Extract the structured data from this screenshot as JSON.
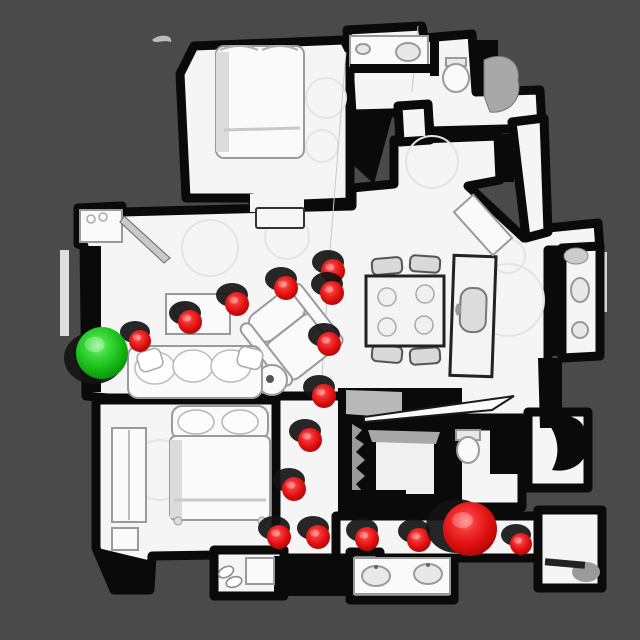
{
  "scene": {
    "description": "Top-down rendered 3D mesh scan of an apartment floor plan with a navigation path shown as spheres",
    "background_color": "#4a4a4a",
    "floor_color": "#f5f5f5",
    "wall_color": "#0a0a0a",
    "view": "top-down"
  },
  "markers": {
    "waypoint_color": "#e01212",
    "start": {
      "label": "start-sphere",
      "color": "#1ec81e",
      "x": 102,
      "y": 353,
      "r": 26
    },
    "goal": {
      "label": "goal-sphere",
      "color": "#e01212",
      "x": 470,
      "y": 529,
      "r": 27
    },
    "waypoints": [
      {
        "x": 333,
        "y": 271,
        "r": 12
      },
      {
        "x": 332,
        "y": 293,
        "r": 12
      },
      {
        "x": 286,
        "y": 288,
        "r": 12
      },
      {
        "x": 237,
        "y": 304,
        "r": 12
      },
      {
        "x": 190,
        "y": 322,
        "r": 12
      },
      {
        "x": 140,
        "y": 341,
        "r": 11
      },
      {
        "x": 329,
        "y": 344,
        "r": 12
      },
      {
        "x": 324,
        "y": 396,
        "r": 12
      },
      {
        "x": 310,
        "y": 440,
        "r": 12
      },
      {
        "x": 294,
        "y": 489,
        "r": 12
      },
      {
        "x": 279,
        "y": 537,
        "r": 12
      },
      {
        "x": 318,
        "y": 537,
        "r": 12
      },
      {
        "x": 367,
        "y": 539,
        "r": 12
      },
      {
        "x": 419,
        "y": 540,
        "r": 12
      },
      {
        "x": 521,
        "y": 544,
        "r": 11
      }
    ]
  }
}
